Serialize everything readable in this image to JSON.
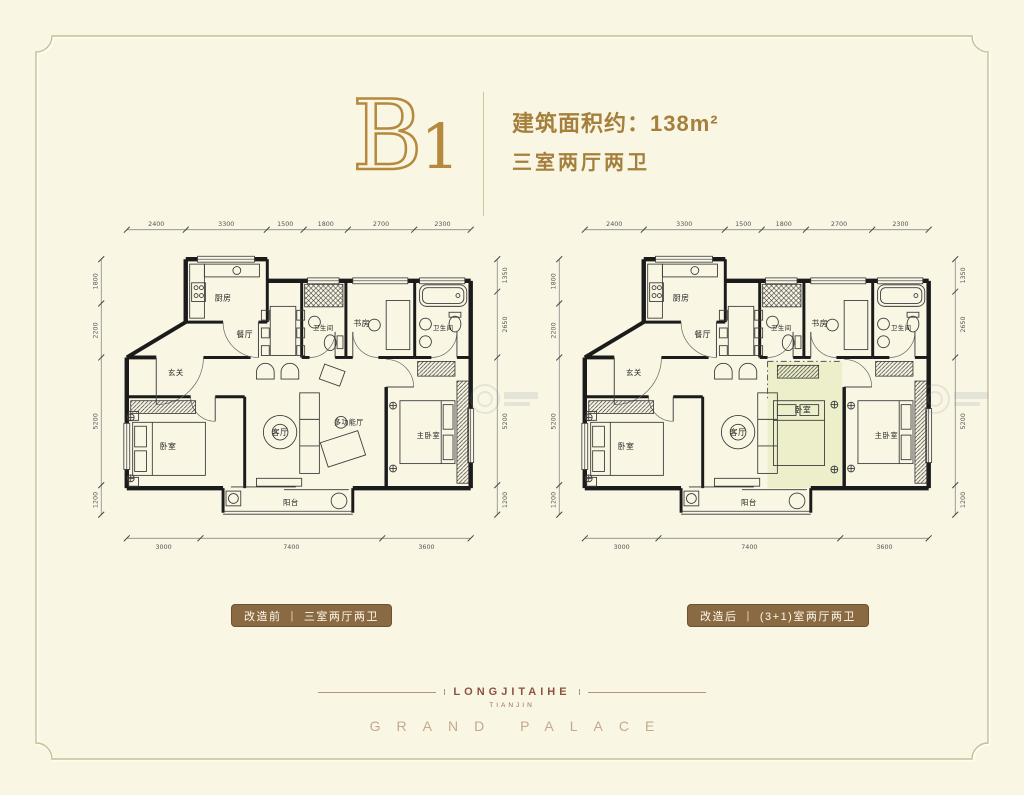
{
  "header": {
    "unit_letter": "B",
    "unit_number": "1",
    "area_line": "建筑面积约：138m²",
    "layout_line": "三室两厅两卫"
  },
  "plans": [
    {
      "id": "before",
      "variant": "before",
      "caption": {
        "prefix": "改造前",
        "separator": "|",
        "text": "三室两厅两卫"
      },
      "rooms": [
        {
          "label": "厨房",
          "x": 168,
          "y": 90,
          "fs": 8
        },
        {
          "label": "餐厅",
          "x": 190,
          "y": 127,
          "fs": 8
        },
        {
          "label": "卫生间",
          "x": 270,
          "y": 120,
          "fs": 6.5
        },
        {
          "label": "书房",
          "x": 309,
          "y": 116,
          "fs": 8
        },
        {
          "label": "卫生间",
          "x": 392,
          "y": 120,
          "fs": 6.5
        },
        {
          "label": "玄关",
          "x": 120,
          "y": 166,
          "fs": 7.5
        },
        {
          "label": "卧室",
          "x": 112,
          "y": 241,
          "fs": 8
        },
        {
          "label": "客厅",
          "x": 226,
          "y": 227,
          "fs": 8
        },
        {
          "label": "多功能厅",
          "x": 296,
          "y": 216,
          "fs": 7
        },
        {
          "label": "主卧室",
          "x": 377,
          "y": 230,
          "fs": 7.5
        },
        {
          "label": "阳台",
          "x": 237,
          "y": 298,
          "fs": 7.5
        }
      ],
      "dims": {
        "top": [
          "2400",
          "3300",
          "1500",
          "1800",
          "2700",
          "2300"
        ],
        "bottom": [
          "3000",
          "7400",
          "3600"
        ],
        "left": [
          "1800",
          "2200",
          "5200",
          "1200"
        ],
        "right": [
          "1350",
          "2650",
          "5200",
          "1200"
        ]
      }
    },
    {
      "id": "after",
      "variant": "after",
      "caption": {
        "prefix": "改造后",
        "separator": "|",
        "text": "(3+1)室两厅两卫"
      },
      "rooms": [
        {
          "label": "厨房",
          "x": 168,
          "y": 90,
          "fs": 8
        },
        {
          "label": "餐厅",
          "x": 190,
          "y": 127,
          "fs": 8
        },
        {
          "label": "卫生间",
          "x": 270,
          "y": 120,
          "fs": 6.5
        },
        {
          "label": "书房",
          "x": 309,
          "y": 116,
          "fs": 8
        },
        {
          "label": "卫生间",
          "x": 392,
          "y": 120,
          "fs": 6.5
        },
        {
          "label": "玄关",
          "x": 120,
          "y": 166,
          "fs": 7.5
        },
        {
          "label": "卧室",
          "x": 112,
          "y": 241,
          "fs": 8
        },
        {
          "label": "客厅",
          "x": 226,
          "y": 227,
          "fs": 8
        },
        {
          "label": "卧室",
          "x": 292,
          "y": 204,
          "fs": 8
        },
        {
          "label": "主卧室",
          "x": 377,
          "y": 230,
          "fs": 7.5
        },
        {
          "label": "阳台",
          "x": 237,
          "y": 298,
          "fs": 7.5
        }
      ],
      "dims": {
        "top": [
          "2400",
          "3300",
          "1500",
          "1800",
          "2700",
          "2300"
        ],
        "bottom": [
          "3000",
          "7400",
          "3600"
        ],
        "left": [
          "1800",
          "2200",
          "5200",
          "1200"
        ],
        "right": [
          "1350",
          "2650",
          "5200",
          "1200"
        ]
      }
    }
  ],
  "footer": {
    "brand": "LONGJITAIHE",
    "city": "TIANJIN",
    "name": "GRAND PALACE"
  },
  "colors": {
    "background": "#faf6e4",
    "frame": "#c9be95",
    "accent_gold": "#b5893e",
    "text_gold": "#a5803c",
    "pill_brown": "#8a6a42",
    "wall": "#1b1b1b",
    "highlight_room": "#edefcb"
  }
}
